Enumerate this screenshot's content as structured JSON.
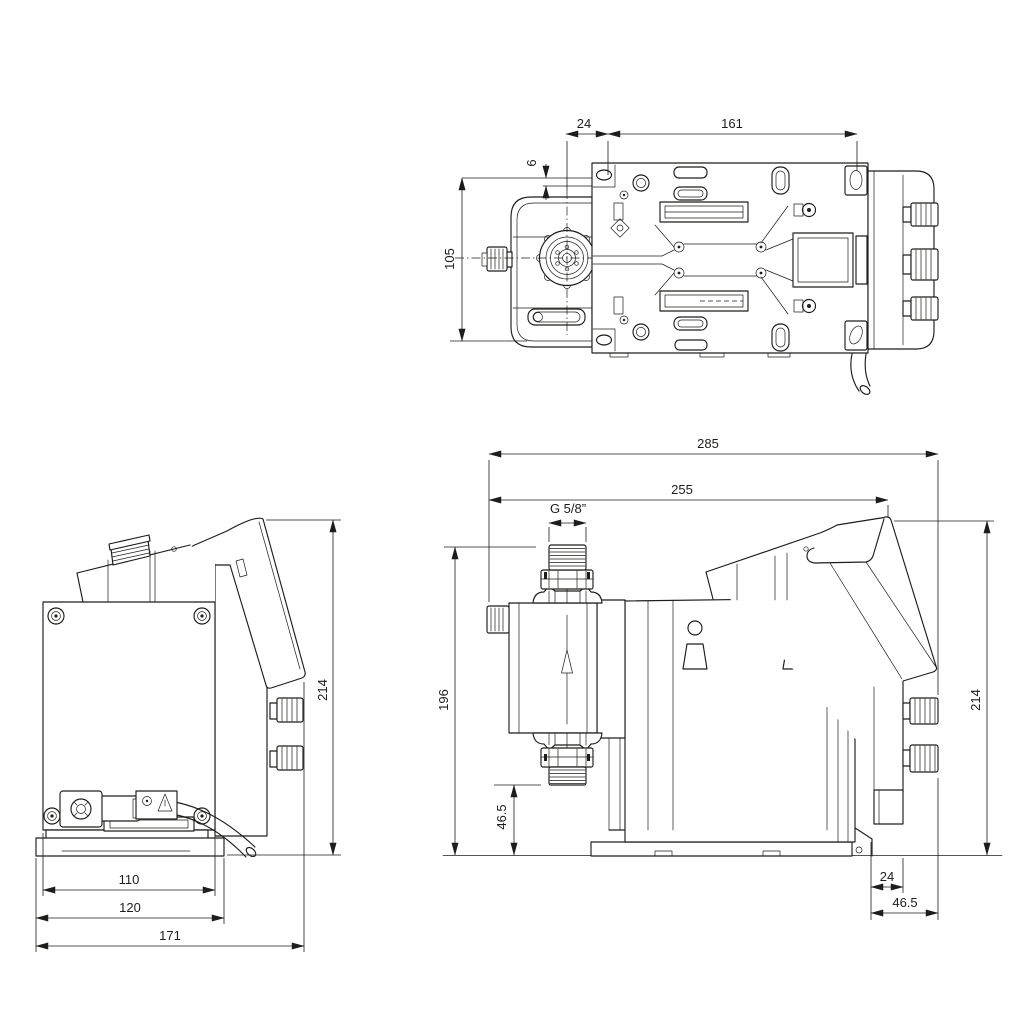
{
  "meta": {
    "background": "#ffffff",
    "ink": "#1d1d1b"
  },
  "top": {
    "d24": "24",
    "d161": "161",
    "d6": "6",
    "d105": "105"
  },
  "front": {
    "d110": "110",
    "d120": "120",
    "d171": "171",
    "d214": "214"
  },
  "side": {
    "d285": "285",
    "d255": "255",
    "thread": "G 5/8”",
    "d196": "196",
    "d46_5_upper": "46.5",
    "d214": "214",
    "d24": "24",
    "d46_5_lower": "46.5"
  }
}
